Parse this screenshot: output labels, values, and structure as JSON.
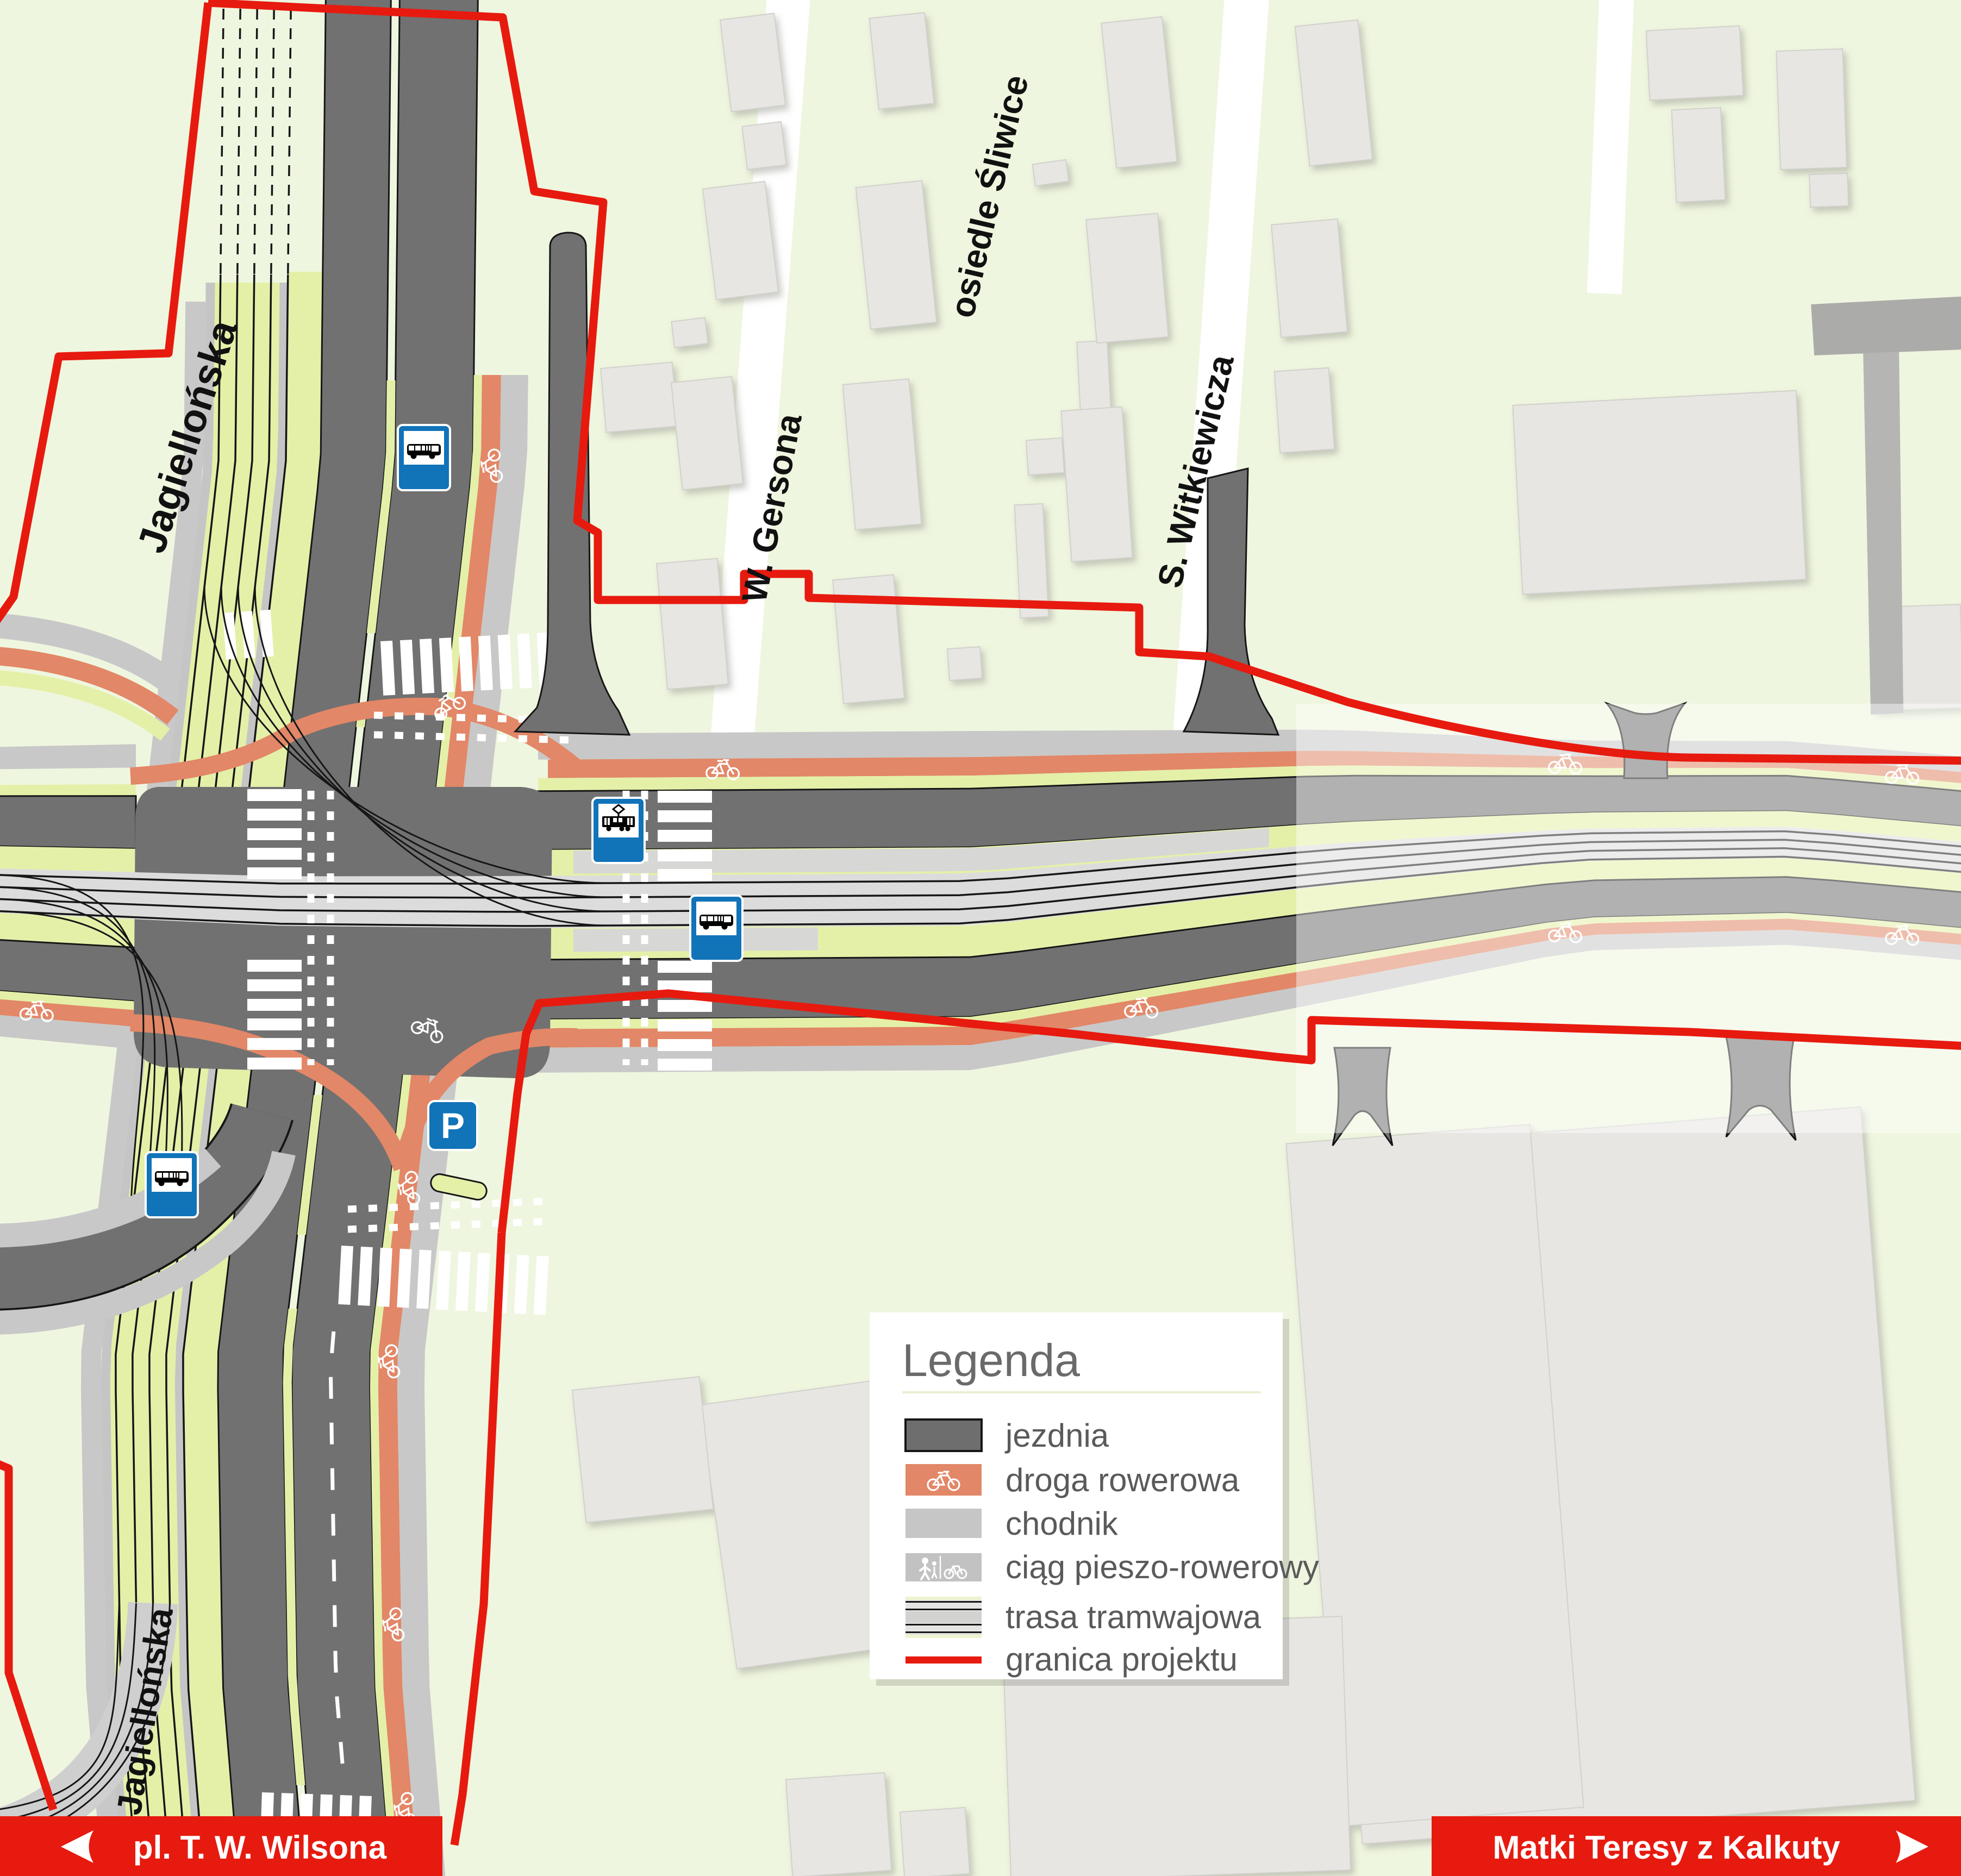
{
  "street_labels": {
    "jagiellonska_top": "Jagiellońska",
    "w_gersona": "W. Gersona",
    "osiedle_sliwice": "osiedle Śliwice",
    "s_witkiewicza": "S. Witkiewicza",
    "jagiellonska_bottom": "Jagiellońska"
  },
  "legend": {
    "title": "Legenda",
    "items": [
      {
        "label": "jezdnia"
      },
      {
        "label": "droga rowerowa"
      },
      {
        "label": "chodnik"
      },
      {
        "label": "ciąg pieszo-rowerowy"
      },
      {
        "label": "trasa tramwajowa"
      },
      {
        "label": "granica projektu"
      }
    ]
  },
  "banners": {
    "left": {
      "label": "pl. T. W. Wilsona"
    },
    "right": {
      "label": "Matki Teresy z Kalkuty"
    }
  },
  "signs": {
    "parking_letter": "P"
  },
  "colors": {
    "background": "#eff6df",
    "road": "#717171",
    "bike_path": "#e28767",
    "sidewalk": "#c8c8c8",
    "green_verge": "#e4f0a8",
    "tram_line": "#161616",
    "boundary_red": "#e71a0f",
    "sign_blue": "#1173b8",
    "building": "#e7e6e2"
  }
}
